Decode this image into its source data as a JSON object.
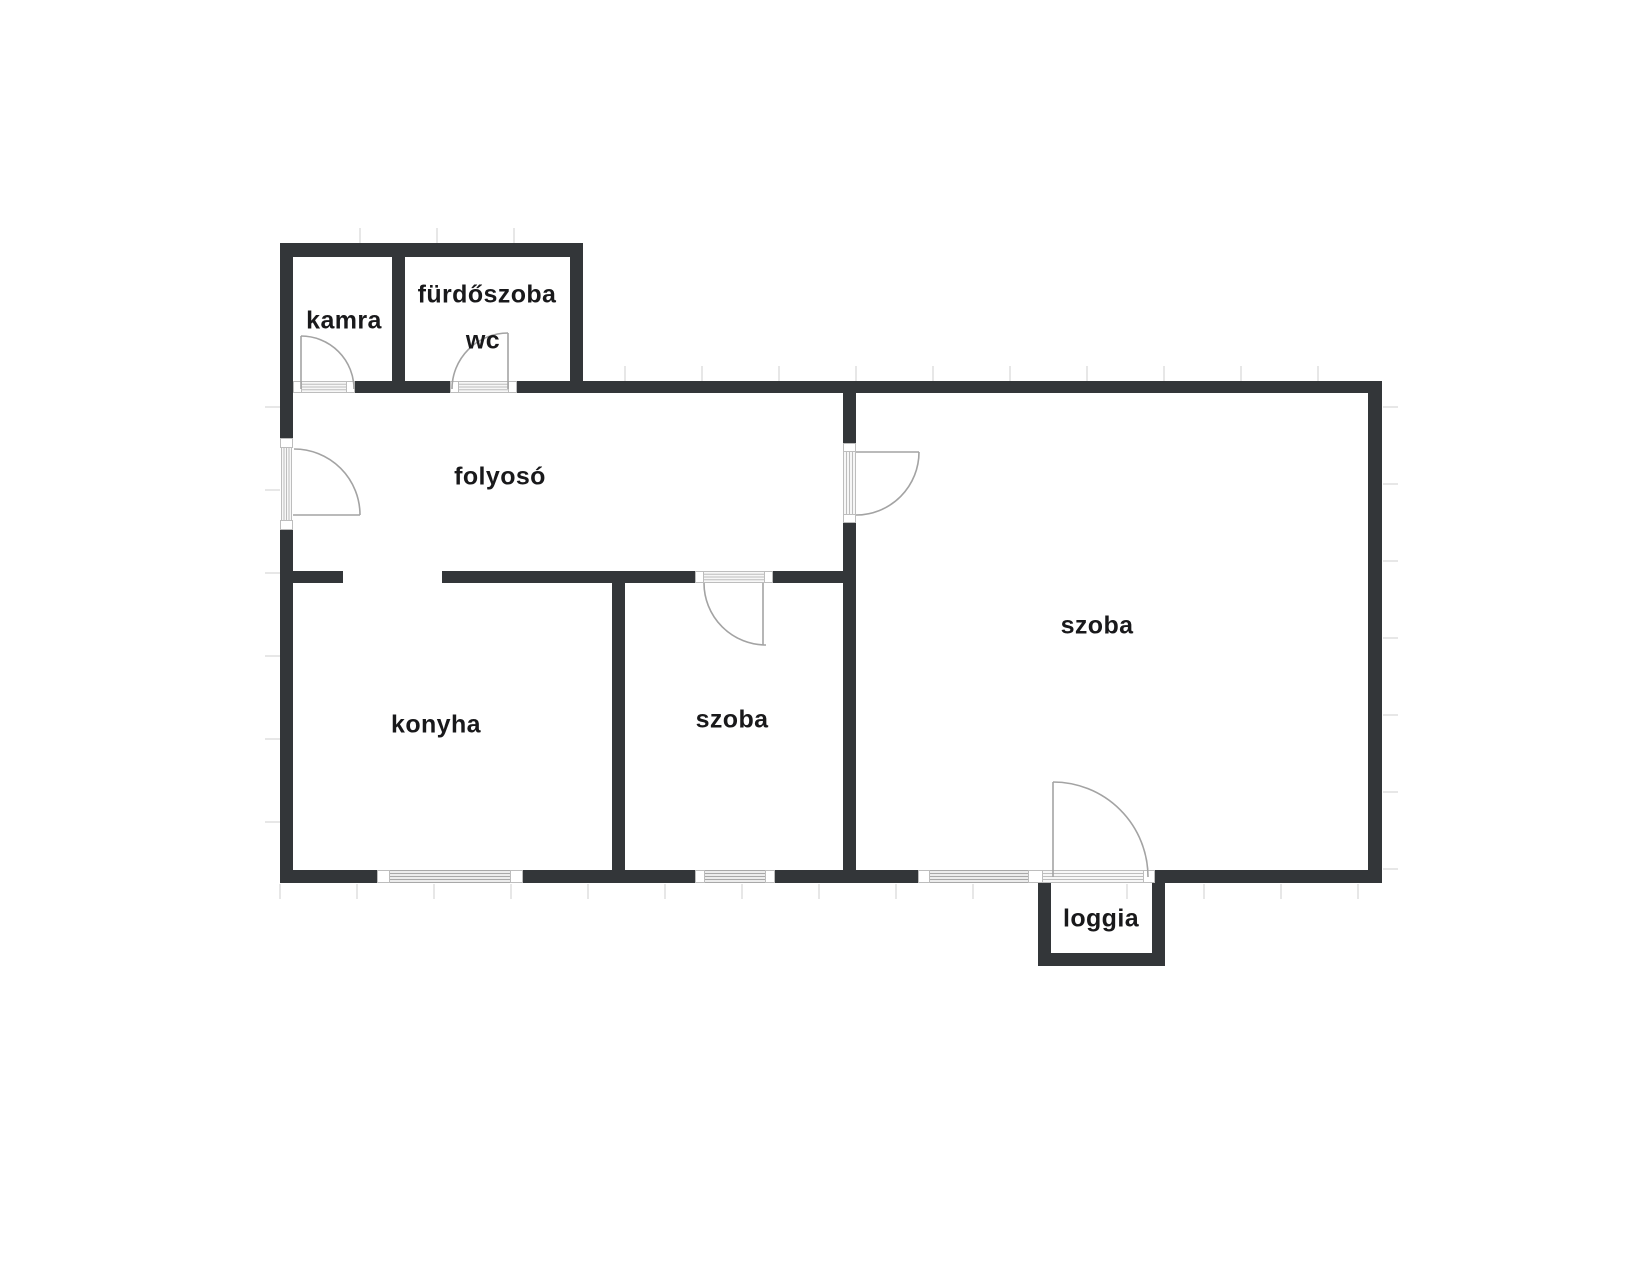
{
  "floorplan": {
    "canvas": {
      "width": 1643,
      "height": 1280,
      "background": "#ffffff"
    },
    "colors": {
      "wall": "#333639",
      "label": "#19191b",
      "swing": "#a3a3a3",
      "window_fill": "#ececec",
      "window_line": "#a8a8a8",
      "door_fill": "#f7f7f7",
      "door_line": "#bdbdbd",
      "post_fill": "#ffffff",
      "post_stroke": "#bdbdbd",
      "tick": "#e7e7e7"
    },
    "rooms": [
      {
        "id": "kamra",
        "label": "kamra",
        "cx": 344,
        "cy": 321,
        "size": 25
      },
      {
        "id": "furdoszoba",
        "label": "fürdőszoba",
        "cx": 487,
        "cy": 295,
        "size": 25
      },
      {
        "id": "wc",
        "label": "wc",
        "cx": 483,
        "cy": 341,
        "size": 25
      },
      {
        "id": "folyoso",
        "label": "folyosó",
        "cx": 500,
        "cy": 477,
        "size": 25
      },
      {
        "id": "konyha",
        "label": "konyha",
        "cx": 436,
        "cy": 725,
        "size": 25
      },
      {
        "id": "szoba-kis",
        "label": "szoba",
        "cx": 732,
        "cy": 720,
        "size": 25
      },
      {
        "id": "szoba-nagy",
        "label": "szoba",
        "cx": 1097,
        "cy": 626,
        "size": 25
      },
      {
        "id": "loggia",
        "label": "loggia",
        "cx": 1101,
        "cy": 919,
        "size": 25
      }
    ],
    "walls": [
      [
        280,
        243,
        303,
        14
      ],
      [
        280,
        243,
        13,
        195
      ],
      [
        280,
        530,
        13,
        353
      ],
      [
        392,
        257,
        13,
        124
      ],
      [
        570,
        257,
        13,
        124
      ],
      [
        355,
        381,
        95,
        12
      ],
      [
        517,
        381,
        865,
        12
      ],
      [
        1368,
        381,
        14,
        502
      ],
      [
        280,
        870,
        97,
        13
      ],
      [
        523,
        870,
        172,
        13
      ],
      [
        775,
        870,
        143,
        13
      ],
      [
        1155,
        870,
        227,
        13
      ],
      [
        293,
        571,
        50,
        12
      ],
      [
        442,
        571,
        253,
        12
      ],
      [
        773,
        571,
        83,
        12
      ],
      [
        612,
        571,
        13,
        312
      ],
      [
        843,
        393,
        13,
        50
      ],
      [
        843,
        523,
        13,
        360
      ],
      [
        1038,
        883,
        13,
        83
      ],
      [
        1152,
        883,
        13,
        83
      ],
      [
        1038,
        953,
        127,
        13
      ]
    ],
    "windows": [
      {
        "id": "kitchen-window",
        "band": [
          390,
          870,
          120,
          13
        ],
        "dir": "h",
        "posts": [
          [
            377,
            870,
            13,
            13
          ],
          [
            510,
            870,
            13,
            13
          ]
        ]
      },
      {
        "id": "small-room-window",
        "band": [
          705,
          870,
          60,
          13
        ],
        "dir": "h",
        "posts": [
          [
            695,
            870,
            10,
            13
          ],
          [
            765,
            870,
            10,
            13
          ]
        ]
      },
      {
        "id": "large-room-window",
        "band": [
          930,
          870,
          98,
          13
        ],
        "dir": "h",
        "posts": [
          [
            918,
            870,
            12,
            13
          ],
          [
            1028,
            870,
            15,
            13
          ]
        ]
      }
    ],
    "doors": [
      {
        "id": "kamra-door",
        "band": [
          302,
          381,
          44,
          12
        ],
        "dir": "h",
        "posts": [
          [
            293,
            381,
            9,
            12
          ],
          [
            346,
            381,
            9,
            12
          ]
        ],
        "leaf": [
          301,
          389,
          301,
          336
        ],
        "arc": {
          "sx": 301,
          "sy": 336,
          "r": 53,
          "ex": 354,
          "ey": 389,
          "sweep": 1
        }
      },
      {
        "id": "wc-door",
        "band": [
          459,
          381,
          49,
          12
        ],
        "dir": "h",
        "posts": [
          [
            450,
            381,
            9,
            12
          ],
          [
            508,
            381,
            9,
            12
          ]
        ],
        "leaf": [
          508,
          389,
          508,
          333
        ],
        "arc": {
          "sx": 508,
          "sy": 333,
          "r": 56,
          "ex": 452,
          "ey": 389,
          "sweep": 0
        }
      },
      {
        "id": "entrance-door",
        "band": [
          281,
          448,
          11,
          72
        ],
        "dir": "v",
        "posts": [
          [
            280,
            438,
            13,
            10
          ],
          [
            280,
            520,
            13,
            10
          ]
        ],
        "leaf": [
          293,
          515,
          360,
          515
        ],
        "arc": {
          "sx": 294,
          "sy": 449,
          "r": 66,
          "ex": 360,
          "ey": 515,
          "sweep": 1
        }
      },
      {
        "id": "large-room-door",
        "band": [
          843,
          452,
          13,
          62
        ],
        "dir": "v",
        "posts": [
          [
            843,
            443,
            13,
            9
          ],
          [
            843,
            514,
            13,
            9
          ]
        ],
        "leaf": [
          856,
          452,
          919,
          452
        ],
        "arc": {
          "sx": 919,
          "sy": 452,
          "r": 63,
          "ex": 856,
          "ey": 515,
          "sweep": 1
        }
      },
      {
        "id": "small-room-door",
        "band": [
          704,
          571,
          60,
          12
        ],
        "dir": "h",
        "posts": [
          [
            695,
            571,
            9,
            12
          ],
          [
            764,
            571,
            9,
            12
          ]
        ],
        "leaf": [
          763,
          583,
          763,
          645
        ],
        "arc": {
          "sx": 704,
          "sy": 583,
          "r": 62,
          "ex": 766,
          "ey": 645,
          "sweep": 0
        }
      },
      {
        "id": "loggia-door",
        "band": [
          1043,
          870,
          100,
          13
        ],
        "dir": "h",
        "posts": [
          [
            1143,
            870,
            12,
            13
          ]
        ],
        "leaf": [
          1053,
          877,
          1053,
          782
        ],
        "arc": {
          "sx": 1053,
          "sy": 782,
          "r": 95,
          "ex": 1148,
          "ey": 877,
          "sweep": 1
        }
      }
    ],
    "ticks": {
      "len": 15,
      "rows": [
        {
          "orient": "v",
          "pos": 228,
          "start": 360,
          "end": 540,
          "step": 77
        },
        {
          "orient": "v",
          "pos": 366,
          "start": 625,
          "end": 1360,
          "step": 77
        },
        {
          "orient": "v",
          "pos": 884,
          "start": 280,
          "end": 1360,
          "step": 77
        },
        {
          "orient": "h",
          "pos": 265,
          "start": 407,
          "end": 860,
          "step": 83
        },
        {
          "orient": "h",
          "pos": 1383,
          "start": 407,
          "end": 869,
          "step": 77
        }
      ]
    }
  }
}
